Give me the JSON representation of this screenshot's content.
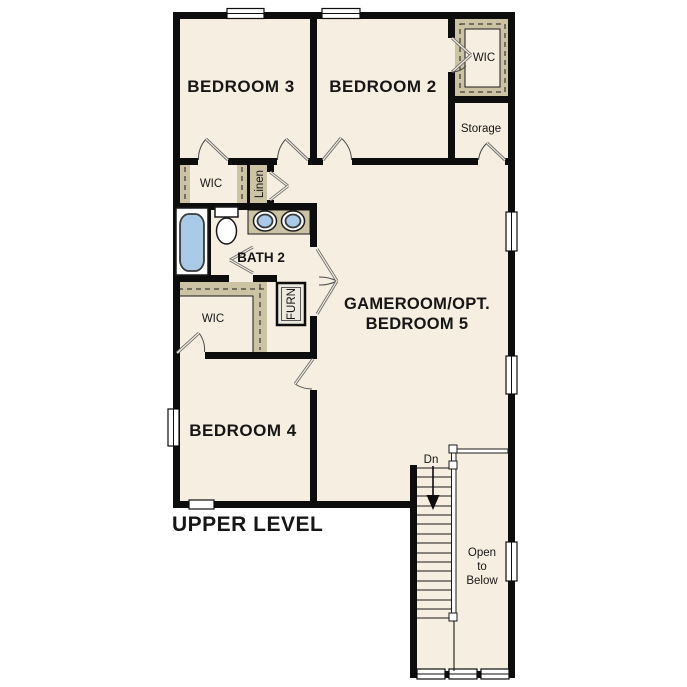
{
  "title": "UPPER LEVEL",
  "colors": {
    "background": "#ffffff",
    "floor": "#f6eee0",
    "closet_shading": "#ccc2a4",
    "wall": "#0d0d0d",
    "fixture_water": "#a9cbe8"
  },
  "labels": {
    "bedroom3": "BEDROOM 3",
    "bedroom2": "BEDROOM 2",
    "wic_top": "WIC",
    "storage": "Storage",
    "wic_mid": "WIC",
    "linen": "Linen",
    "bath2": "BATH 2",
    "gameroom": [
      "GAMEROOM/OPT.",
      "BEDROOM 5"
    ],
    "wic_lower": "WIC",
    "furnace": "FURN",
    "bedroom4": "BEDROOM 4",
    "stairs_down": "Dn",
    "open_to_below": [
      "Open",
      "to",
      "Below"
    ]
  }
}
